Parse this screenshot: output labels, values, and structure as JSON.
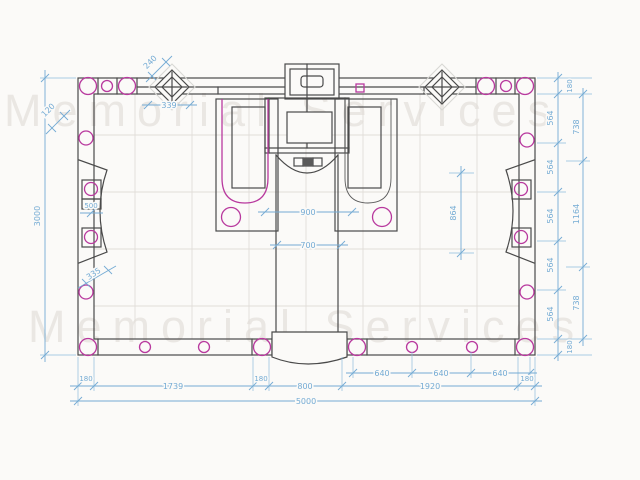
{
  "watermark": {
    "text": "Memorial Services"
  },
  "colors": {
    "dimension_blue": "#74abd4",
    "line_dark": "#4a4a4a",
    "fixture_magenta": "#b8399e",
    "grid_gray": "#e0ddd8",
    "watermark_gray": "#eae7e3",
    "background": "#fbfaf8"
  },
  "dimensions": {
    "overall": {
      "width": "5000",
      "height": "3000"
    },
    "bottom_main": [
      "180",
      "1739",
      "180",
      "800",
      "1920",
      "180"
    ],
    "bottom_inner": [
      "640",
      "640",
      "640"
    ],
    "right_inner": [
      "180",
      "564",
      "564",
      "564",
      "564",
      "564",
      "180"
    ],
    "right_outer": [
      "738",
      "1164",
      "738"
    ],
    "interior": {
      "front": "900",
      "aisle": "700",
      "side": "864"
    },
    "top": {
      "column": "240",
      "offset": "339"
    },
    "left": {
      "corner": "120",
      "panel": "500",
      "diag": "335"
    }
  }
}
